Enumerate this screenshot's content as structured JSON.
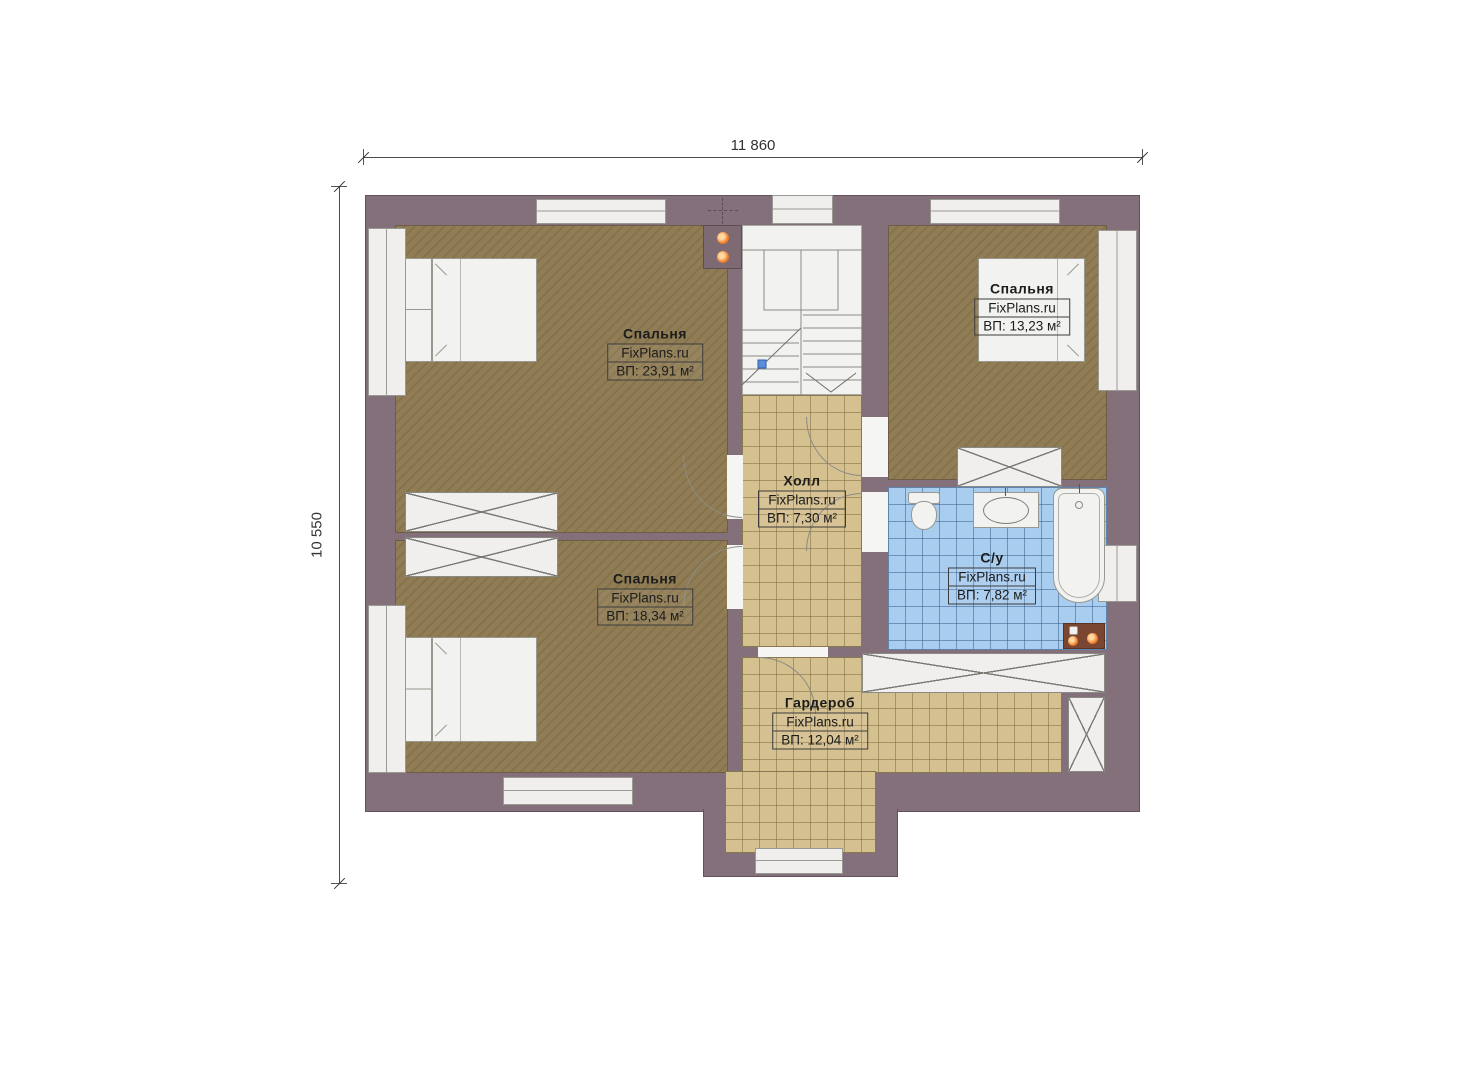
{
  "dims": {
    "top": "11 860",
    "left": "10 550"
  },
  "brand": "FixPlans.ru",
  "rooms": {
    "bedroom_top_left": {
      "name": "Спальня",
      "brand": "FixPlans.ru",
      "area": "ВП: 23,91 м²"
    },
    "bedroom_top_right": {
      "name": "Спальня",
      "brand": "FixPlans.ru",
      "area": "ВП: 13,23 м²"
    },
    "bedroom_bottom_left": {
      "name": "Спальня",
      "brand": "FixPlans.ru",
      "area": "ВП: 18,34 м²"
    },
    "hall": {
      "name": "Холл",
      "brand": "FixPlans.ru",
      "area": "ВП: 7,30 м²"
    },
    "bathroom": {
      "name": "С/у",
      "brand": "FixPlans.ru",
      "area": "ВП: 7,82 м²"
    },
    "wardrobe": {
      "name": "Гардероб",
      "brand": "FixPlans.ru",
      "area": "ВП: 12,04 м²"
    }
  },
  "colors": {
    "wall": "#84707a",
    "floor_wood": "#8d7950",
    "floor_tile_tan": "#d5c08f",
    "floor_tile_blue": "#a9cdee",
    "fixture_white": "#f2f2f0",
    "accent_orange": "#f08030"
  }
}
